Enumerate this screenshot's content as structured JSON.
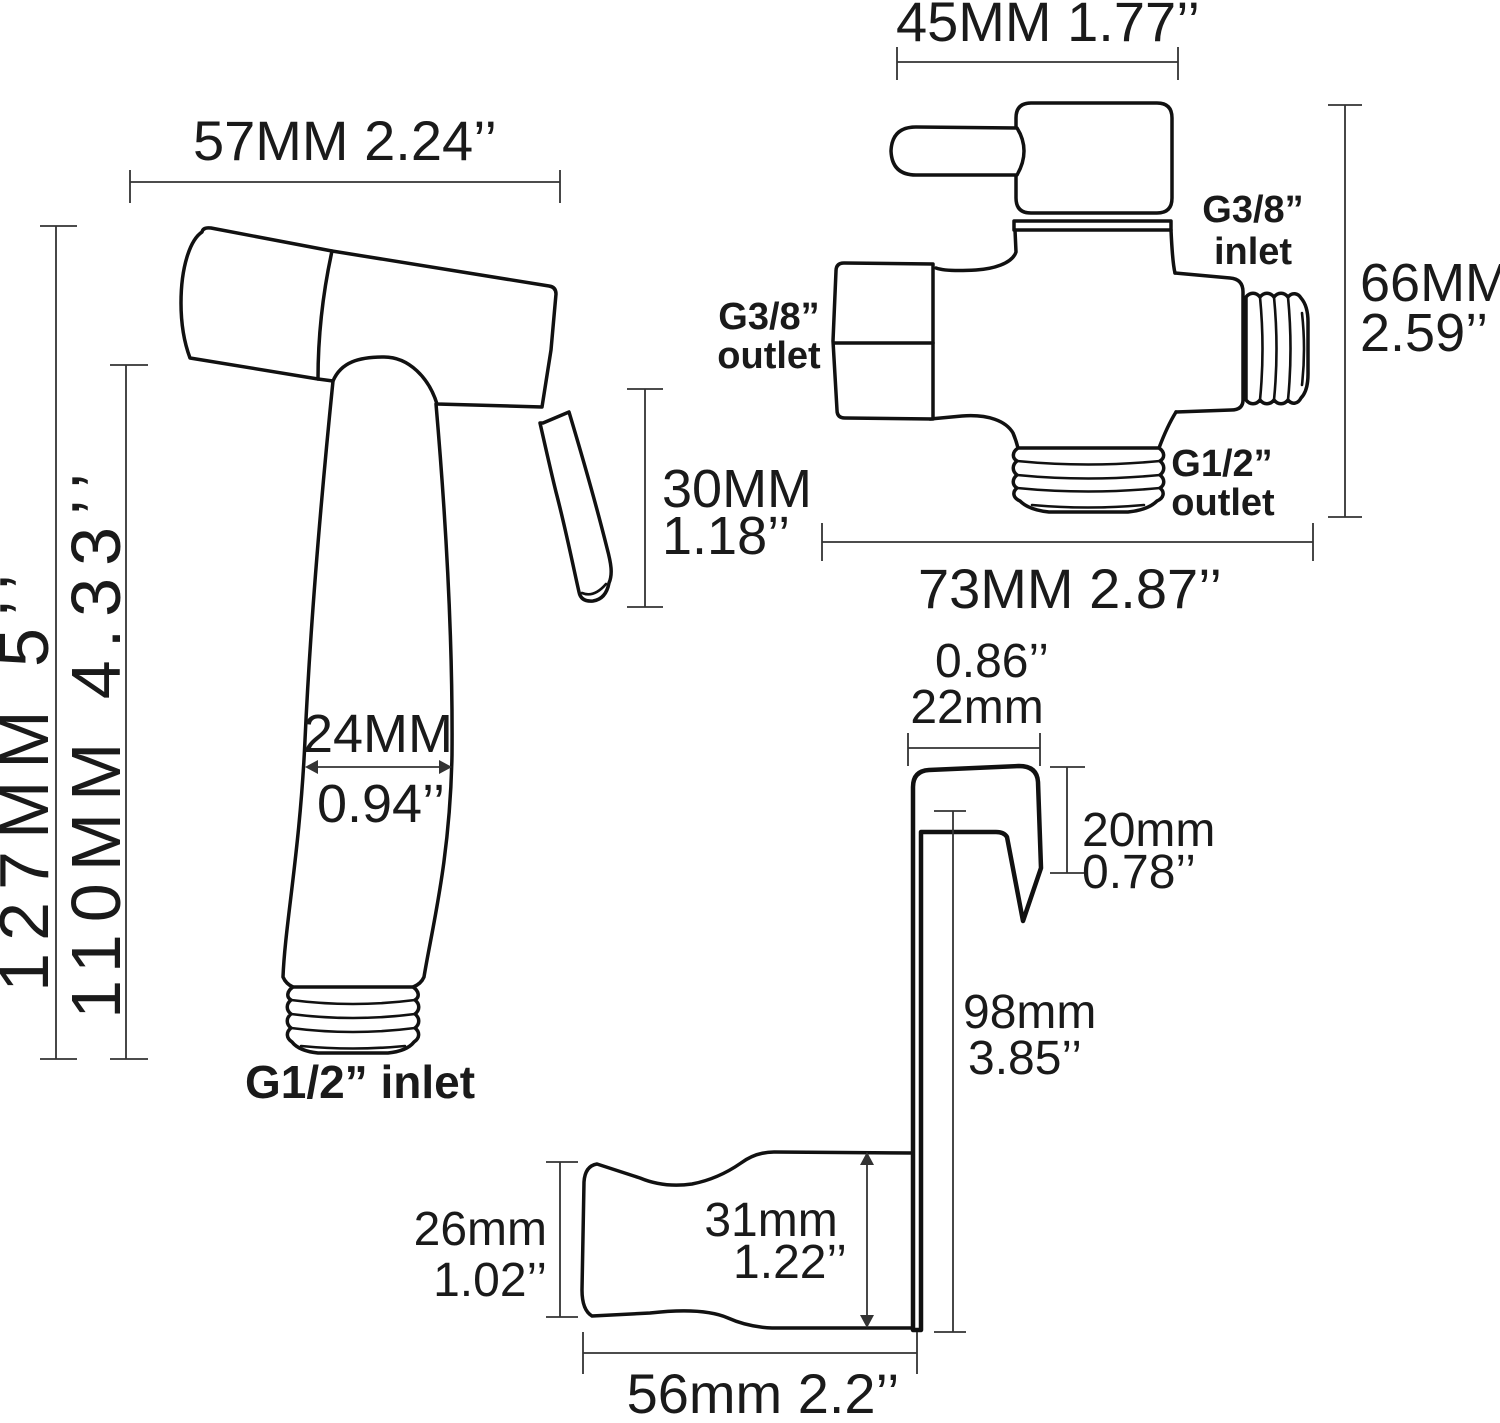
{
  "diagram_title": "bidet sprayer set dimension diagram",
  "colors": {
    "line": "#111111",
    "dim_line": "#333333",
    "text": "#1a1a1a",
    "background": "#ffffff"
  },
  "sprayer": {
    "dim_width": "57MM 2.24’’",
    "dim_height_total": "127MM 5’’",
    "dim_height_body": "110MM 4.33’’",
    "dim_trigger_mm": "30MM",
    "dim_trigger_in": "1.18’’",
    "dim_grip_mm": "24MM",
    "dim_grip_in": "0.94’’",
    "inlet_label": "G1/2” inlet"
  },
  "valve": {
    "dim_top_width": "45MM 1.77’’",
    "dim_height_mm": "66MM",
    "dim_height_in": "2.59’’",
    "dim_bottom_width": "73MM 2.87’’",
    "inlet_right_line1": "G3/8”",
    "inlet_right_line2": "inlet",
    "outlet_left_line1": "G3/8”",
    "outlet_left_line2": "outlet",
    "outlet_bottom_line1": "G1/2”",
    "outlet_bottom_line2": "outlet"
  },
  "holder": {
    "dim_hook_width_in": "0.86’’",
    "dim_hook_width_mm": "22mm",
    "dim_hook_drop_mm": "20mm",
    "dim_hook_drop_in": "0.78’’",
    "dim_stem_mm": "98mm",
    "dim_stem_in": "3.85’’",
    "dim_cup_mm": "31mm",
    "dim_cup_in": "1.22’’",
    "dim_cup_left_mm": "26mm",
    "dim_cup_left_in": "1.02’’",
    "dim_cup_width": "56mm 2.2’’"
  }
}
